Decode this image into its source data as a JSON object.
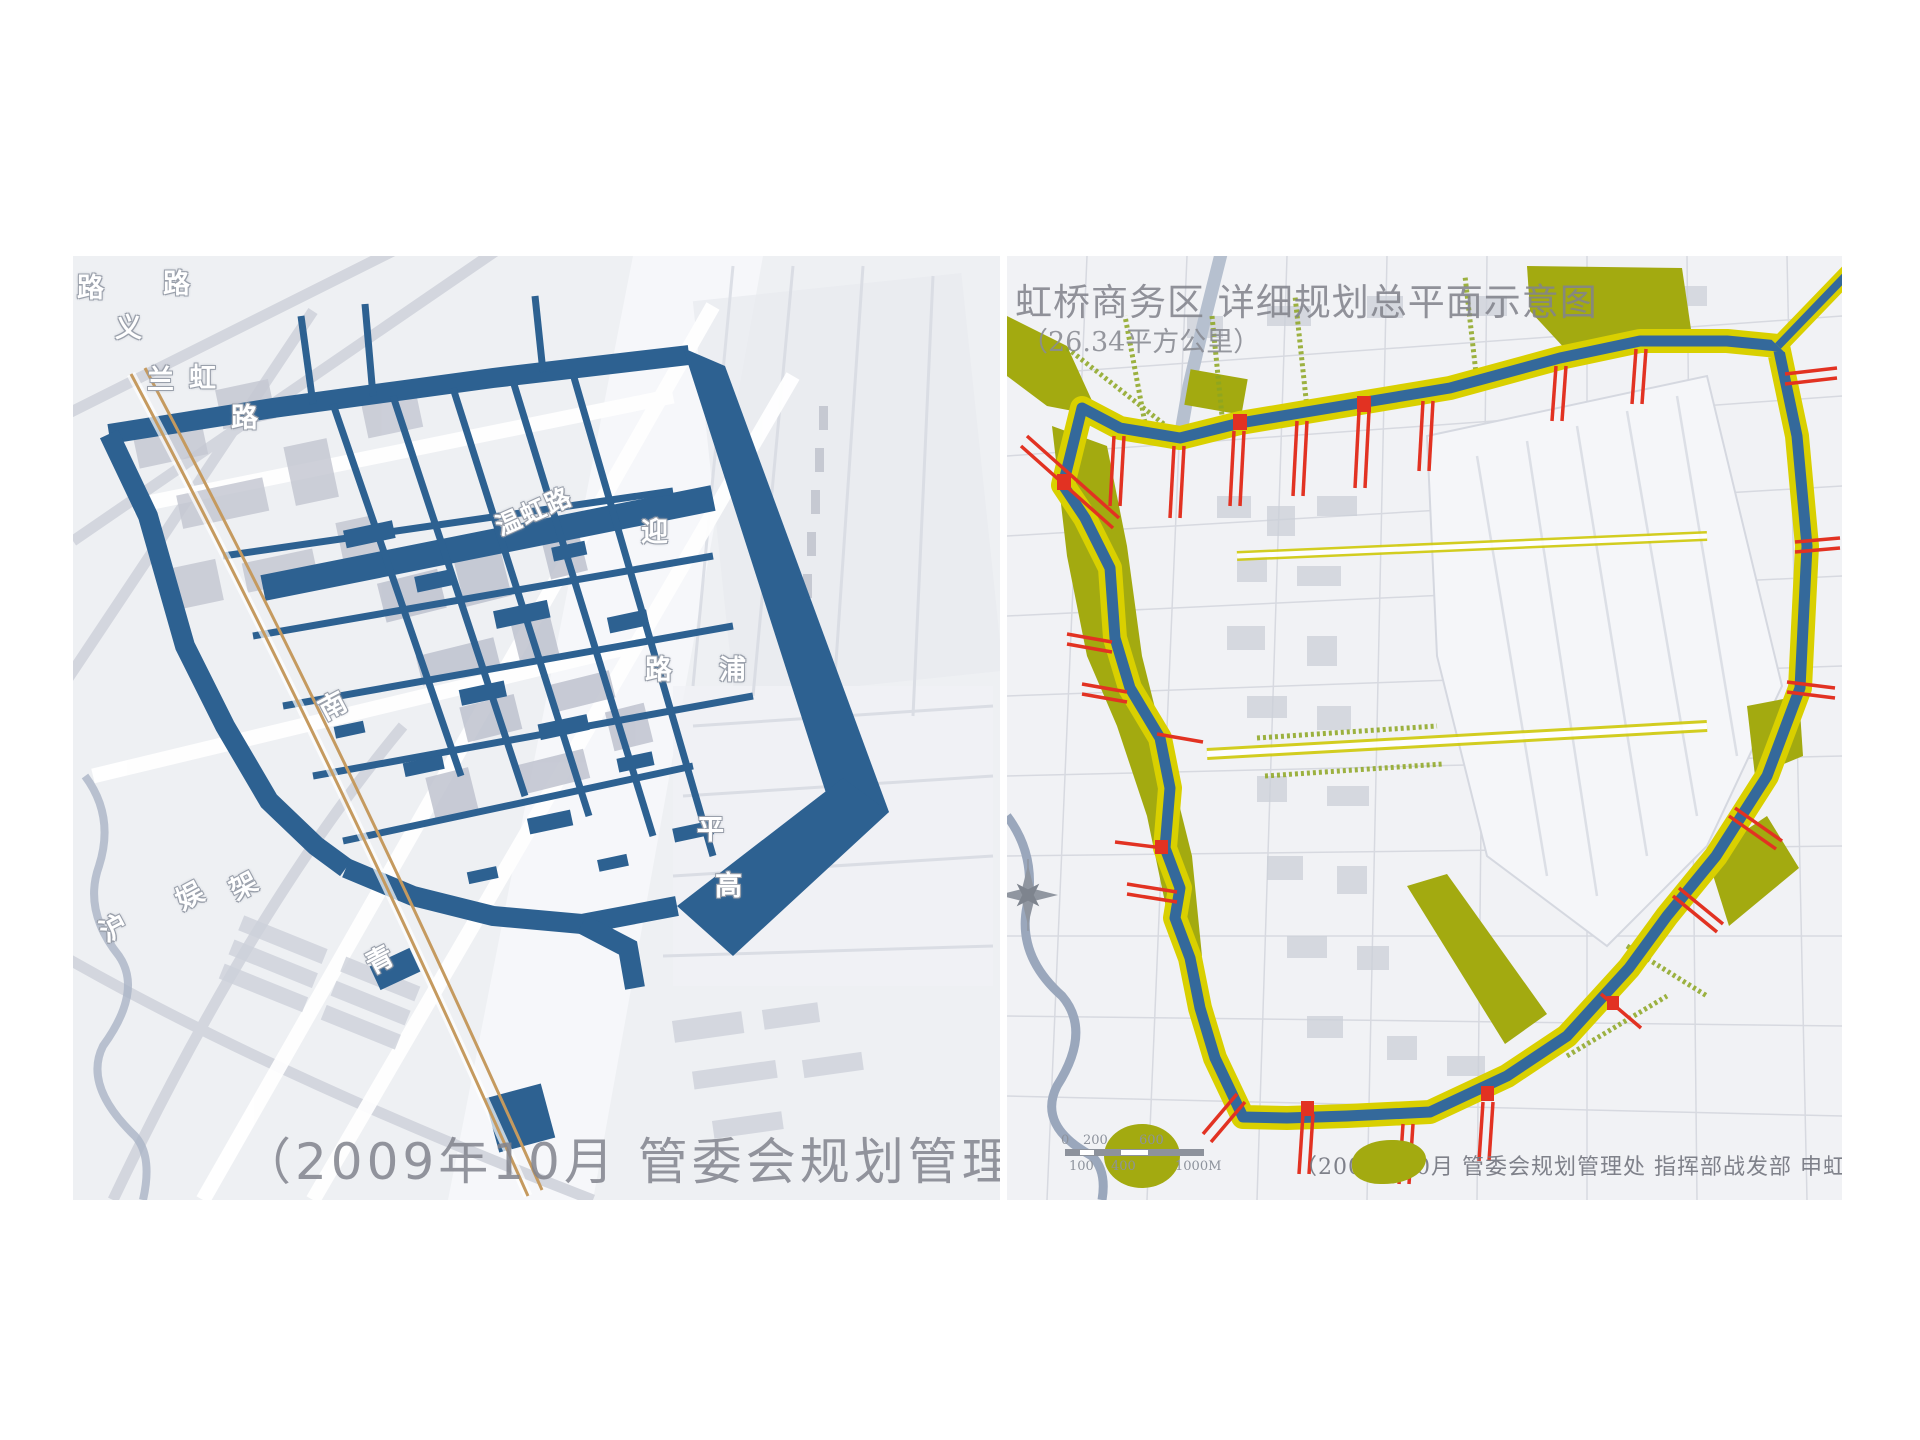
{
  "page": {
    "background": "#ffffff",
    "description_labels": {
      "left_map": "road network plan",
      "right_map": "Hongqiao business district master plan"
    }
  },
  "left_map": {
    "caption": "（2009年10月 管委会规划管理处",
    "road_labels": [
      {
        "text": "路"
      },
      {
        "text": "路"
      },
      {
        "text": "义"
      },
      {
        "text": "兰"
      },
      {
        "text": "虹"
      },
      {
        "text": "路"
      },
      {
        "text": "温虹路"
      },
      {
        "text": "南"
      },
      {
        "text": "架"
      },
      {
        "text": "青"
      },
      {
        "text": "娱"
      },
      {
        "text": "沪"
      },
      {
        "text": "迎"
      },
      {
        "text": "路"
      },
      {
        "text": "浦"
      },
      {
        "text": "平"
      },
      {
        "text": "高"
      }
    ],
    "colors": {
      "network_blue": "#2d6191",
      "railway_tan": "#c59a5f",
      "basemap_bg": "#eef0f3",
      "building_gray": "#c6c9d3"
    }
  },
  "right_map": {
    "title": "虹桥商务区 详细规划总平面示意图",
    "subtitle": "（26.34平方公里）",
    "caption": "（2009年10月 管委会规划管理处 指挥部战发部 申虹公司报",
    "scale_bar": {
      "top_labels": [
        "0",
        "200",
        "600"
      ],
      "bottom_labels": [
        "100",
        "400",
        "1000M"
      ]
    },
    "colors": {
      "boundary_blue": "#34699b",
      "band_yellow": "#d9d000",
      "olive_green": "#a3aa10",
      "bridge_red": "#e23222",
      "river_gray": "#aab6c8"
    }
  }
}
